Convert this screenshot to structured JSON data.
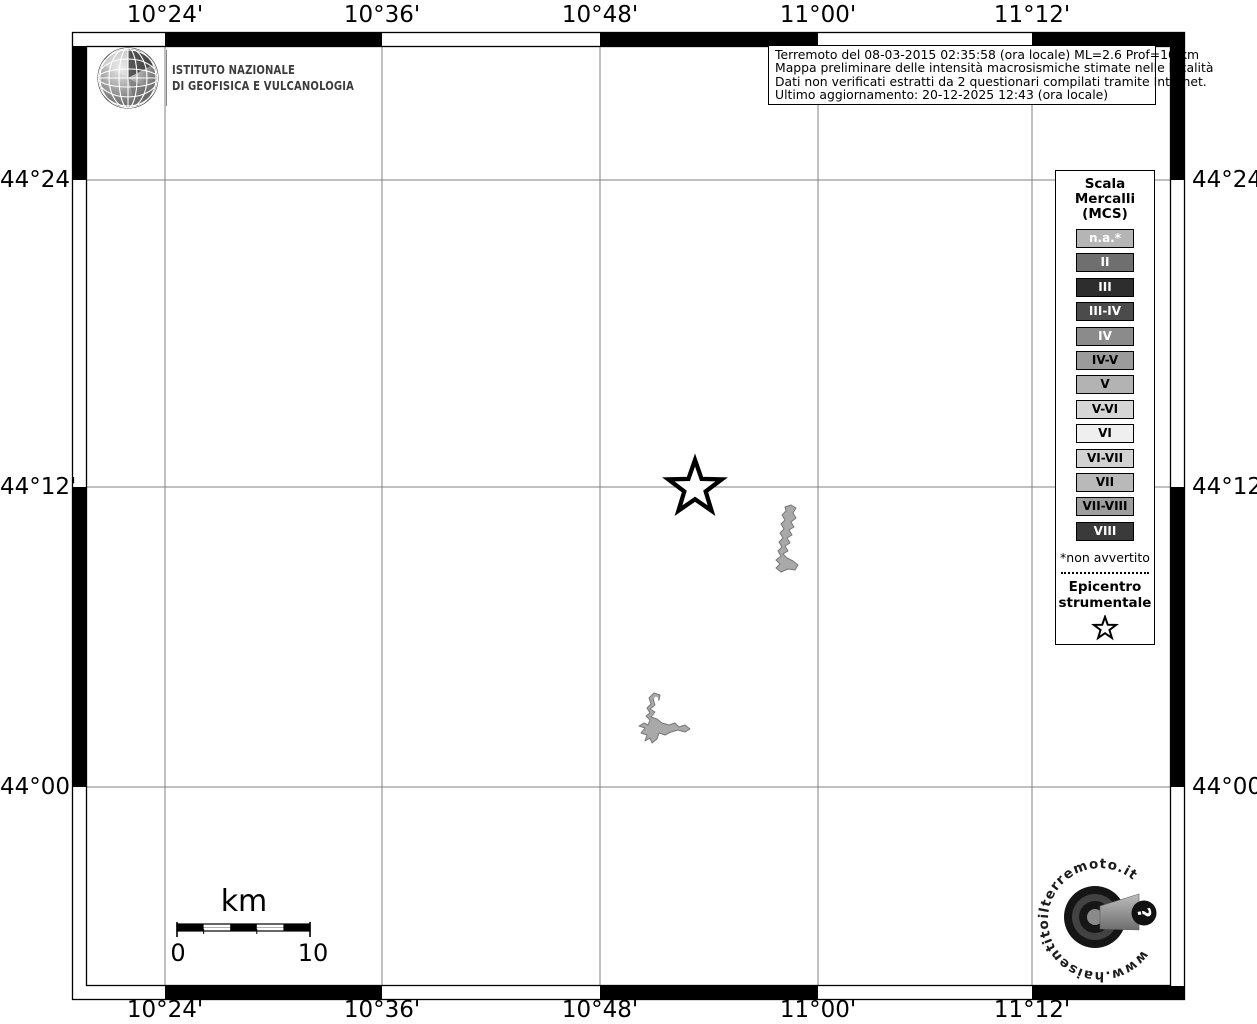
{
  "branding": {
    "ingv_line1": "ISTITUTO NAZIONALE",
    "ingv_line2": "DI GEOFISICA E VULCANOLOGIA"
  },
  "info_box": {
    "line1": "Terremoto del 08-03-2015 02:35:58 (ora locale) ML=2.6 Prof=10 km",
    "line2": "Mappa preliminare delle intensità macrosismiche stimate nelle località",
    "line3": "Dati non verificati estratti da 2 questionari compilati tramite Internet.",
    "line4": "Ultimo aggiornamento: 20-12-2025 12:43 (ora locale)"
  },
  "axes": {
    "top": [
      "10°24'",
      "10°36'",
      "10°48'",
      "11°00'",
      "11°12'"
    ],
    "bottom": [
      "10°24'",
      "10°36'",
      "10°48'",
      "11°00'",
      "11°12'"
    ],
    "left": [
      "44°24'",
      "44°12'",
      "44°00'"
    ],
    "right": [
      "44°24'",
      "44°12'",
      "44°00'"
    ]
  },
  "legend": {
    "title_lines": [
      "Scala",
      "Mercalli",
      "(MCS)"
    ],
    "items": [
      {
        "label": "n.a.*",
        "color": "#b5b5b5",
        "text_color": "#ffffff"
      },
      {
        "label": "II",
        "color": "#6f6f6f",
        "text_color": "#ffffff"
      },
      {
        "label": "III",
        "color": "#2d2d2d",
        "text_color": "#ffffff"
      },
      {
        "label": "III-IV",
        "color": "#4b4b4b",
        "text_color": "#ffffff"
      },
      {
        "label": "IV",
        "color": "#8b8b8b",
        "text_color": "#ffffff"
      },
      {
        "label": "IV-V",
        "color": "#9b9b9b",
        "text_color": "#000000"
      },
      {
        "label": "V",
        "color": "#b3b3b3",
        "text_color": "#000000"
      },
      {
        "label": "V-VI",
        "color": "#d6d6d6",
        "text_color": "#000000"
      },
      {
        "label": "VI",
        "color": "#efefef",
        "text_color": "#000000"
      },
      {
        "label": "VI-VII",
        "color": "#d2d2d2",
        "text_color": "#000000"
      },
      {
        "label": "VII",
        "color": "#b9b9b9",
        "text_color": "#000000"
      },
      {
        "label": "VII-VIII",
        "color": "#9e9e9e",
        "text_color": "#000000"
      },
      {
        "label": "VIII",
        "color": "#3a3a3a",
        "text_color": "#ffffff"
      }
    ],
    "footnote": "*non avvertito",
    "epicenter_line1": "Epicentro",
    "epicenter_line2": "strumentale",
    "epicenter_symbol": "star-outline-icon"
  },
  "scale_bar": {
    "unit": "km",
    "start_label": "0",
    "end_label": "10"
  },
  "map_symbols": {
    "epicenter_marker": "star-outline-icon",
    "water_body_color": "#a9a9a9"
  },
  "watermark": {
    "circular_text": "www.haisentitoilterremoto.it",
    "icon_text": "?"
  }
}
